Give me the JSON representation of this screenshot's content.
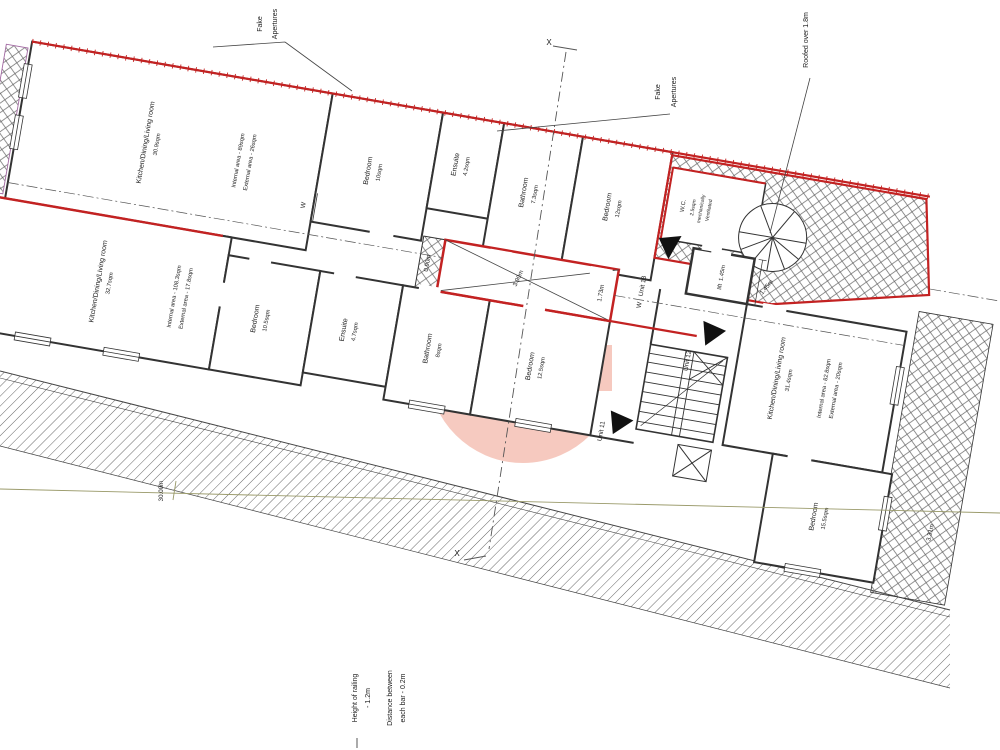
{
  "annotations": {
    "fake_apertures_top": {
      "line1": "Fake",
      "line2": "Apertures"
    },
    "fake_apertures_mid": {
      "line1": "Fake",
      "line2": "Apertures"
    },
    "roofed_over": "Roofed over 1.8m",
    "section_marker_top": "X",
    "section_marker_bottom": "X",
    "railing_note": {
      "line1": "Height of railing",
      "line2": "- 1.2m",
      "line3": "Distance between",
      "line4": "each bar - 0.2m"
    }
  },
  "units": {
    "top": {
      "name": "Kitchen/Dining/Living room",
      "area": "30.9sqm",
      "internal": "Internal area - 89sqm",
      "external": "External area - 26sqm"
    },
    "left": {
      "name": "Kitchen/Dining/Living room",
      "area": "32.7sqm",
      "internal": "Internal area - 108.3sqm",
      "external": "External area - 17.8sqm"
    },
    "right": {
      "name": "Kitchen/Dining/Living room",
      "area": "31.4sqm",
      "internal": "Internal area - 82.8sqm",
      "external": "External area - 20sqm"
    }
  },
  "rooms": {
    "bedroom_top": {
      "name": "Bedroom",
      "area": "10sqm"
    },
    "ensuite_top": {
      "name": "Ensuite",
      "area": "4.2sqm"
    },
    "bathroom_top": {
      "name": "Bathroom",
      "area": "7.3sqm"
    },
    "bedroom_top2": {
      "name": "Bedroom",
      "area": "12sqm"
    },
    "wc": {
      "name": "W.C.",
      "area": "2.5sqm",
      "note1": "mechanically",
      "note2": "Ventilated"
    },
    "lift": {
      "name": "lift",
      "size": "1.45m"
    },
    "bedroom_left": {
      "name": "Bedroom",
      "area": "10.5sqm"
    },
    "ensuite_left": {
      "name": "Ensuite",
      "area": "4.7sqm"
    },
    "bathroom_left": {
      "name": "Bathroom",
      "area": "8sqm"
    },
    "bedroom_mid": {
      "name": "Bedroom",
      "area": "12.5sqm"
    },
    "bedroom_right": {
      "name": "Bedroom",
      "area": "15.5sqm"
    }
  },
  "unit_markers": {
    "unit11": "Unit 11",
    "unit12": "Unit 12",
    "unit13": "Unit 13",
    "unit13_prefix": "W"
  },
  "wardrobe_label": "W",
  "dimensions": {
    "d090": "0.90m",
    "d390": "3.90m",
    "d173": "1.73m",
    "d145": "1.45m",
    "d3000": "30.00m",
    "d331": "3.31m"
  },
  "colors": {
    "wall_red": "#c32222",
    "watermark_pink": "#ec8a73",
    "survey_line_olive": "#9a9a6a"
  }
}
